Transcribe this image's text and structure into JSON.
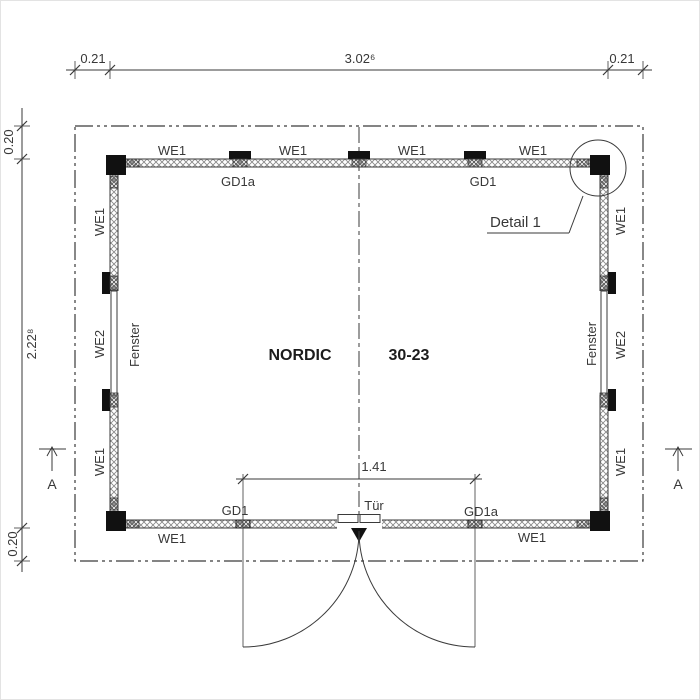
{
  "labels": {
    "we1": "WE1",
    "we2": "WE2",
    "gd1": "GD1",
    "gd1a": "GD1a",
    "fenster": "Fenster",
    "tuer": "Tür",
    "detail_1": "Detail 1",
    "section_a": "A",
    "model_name": "NORDIC",
    "model_code": "30-23"
  },
  "dimensions": {
    "overhang_left": "0.21",
    "overall_width": "3.02⁶",
    "overhang_right": "0.21",
    "overhang_top": "0.20",
    "overall_depth": "2.22⁸",
    "overhang_bottom": "0.20",
    "door_opening": "1.41"
  },
  "colors": {
    "line": "#3a3a3a",
    "post": "#111111",
    "hatch": "#8a8a8a",
    "background": "#ffffff"
  }
}
